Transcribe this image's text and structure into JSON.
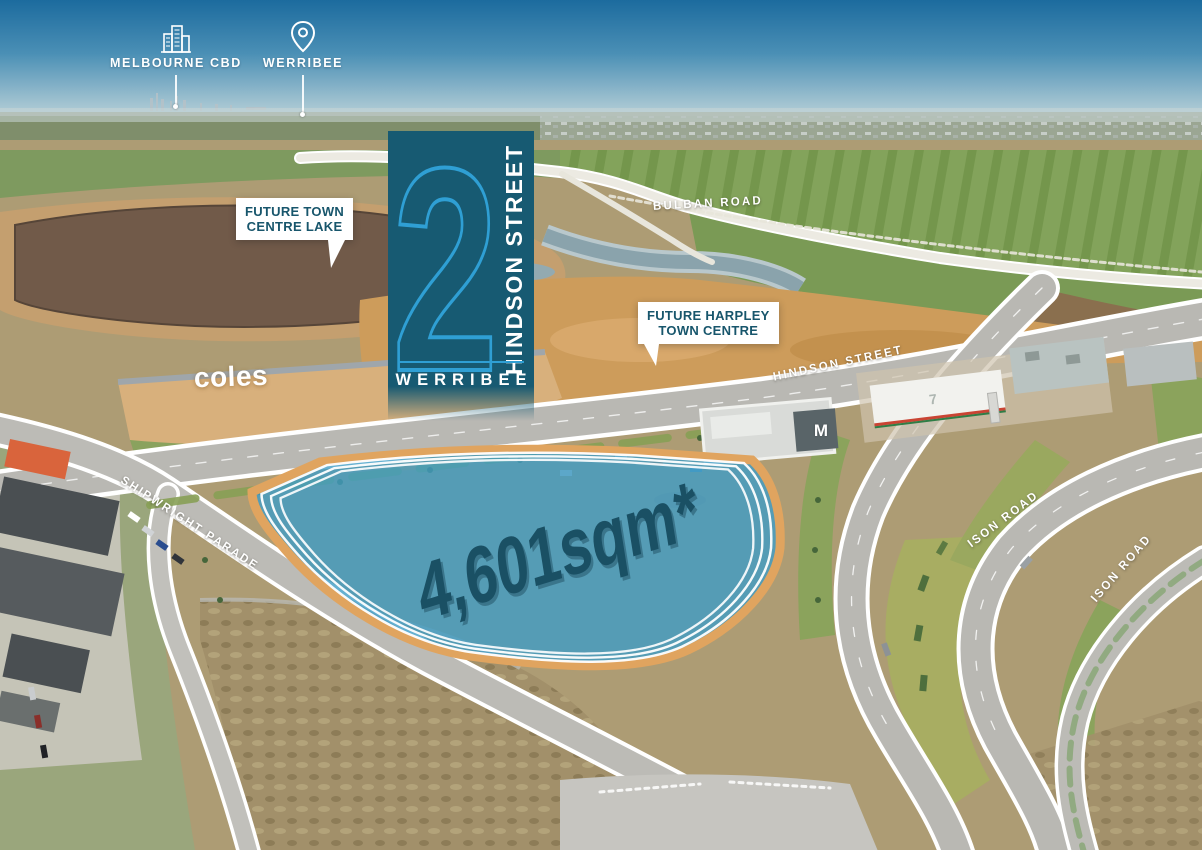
{
  "title_block": {
    "lot_number": "2",
    "street": "HINDSON STREET",
    "suburb": "WERRIBEE"
  },
  "site": {
    "area_label": "4,601sqm*"
  },
  "distance_markers": [
    {
      "id": "melbourne-cbd",
      "label": "MELBOURNE CBD",
      "icon": "city-skyline-icon"
    },
    {
      "id": "werribee",
      "label": "WERRIBEE",
      "icon": "map-pin-icon"
    }
  ],
  "callouts": [
    {
      "id": "future-town-centre-lake",
      "line1": "FUTURE TOWN",
      "line2": "CENTRE LAKE"
    },
    {
      "id": "future-harpley-town-centre",
      "line1": "FUTURE HARPLEY",
      "line2": "TOWN CENTRE"
    }
  ],
  "road_labels": {
    "bulban": "BULBAN ROAD",
    "hindson": "HINDSON STREET",
    "shipwright": "SHIPWRIGHT PARADE",
    "ison_north": "ISON ROAD",
    "ison_south": "ISON ROAD"
  },
  "landmarks": {
    "coles": "coles",
    "seven_eleven": "7",
    "mcdonalds": "M"
  },
  "colors": {
    "banner_teal": "#175A72",
    "banner_accent_blue": "#2F9FD4",
    "callout_text_teal": "#18566C",
    "site_fill_blue": "#3F9CC6",
    "site_border_orange": "#E0A45F",
    "site_area_text_teal": "#1A5064",
    "road_label_white": "#FFFFFF"
  }
}
